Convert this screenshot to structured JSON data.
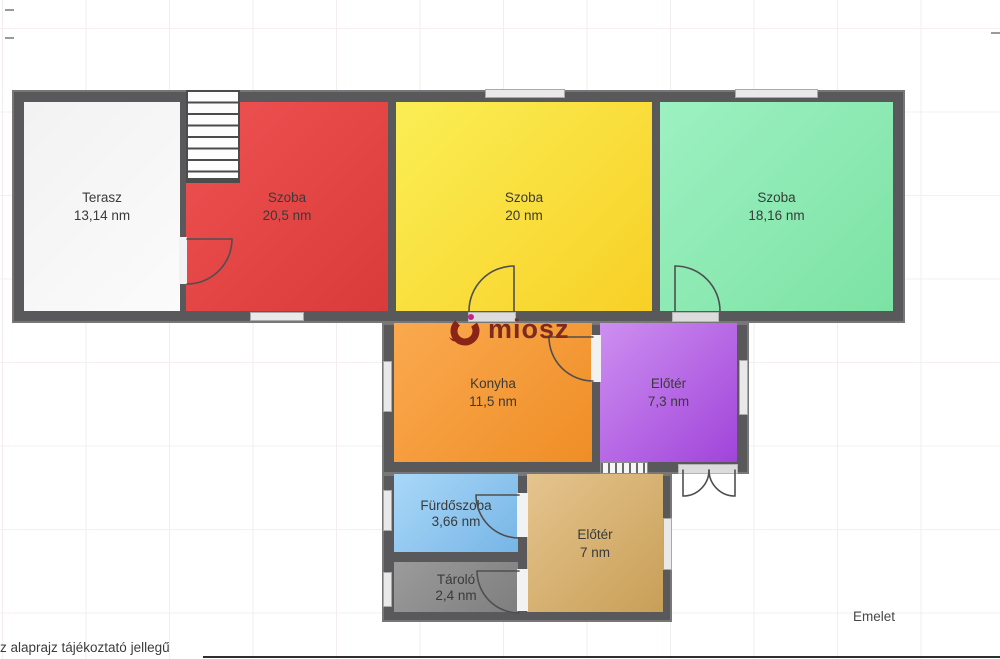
{
  "meta": {
    "floor_label": "Emelet",
    "disclaimer": "z alaprajz tájékoztató jellegű",
    "plan_type": "floor-plan"
  },
  "logo": {
    "text": "miosz",
    "text_color": "#7d2b1f",
    "swirl_color": "#8a2416",
    "dot_color": "#c2258a"
  },
  "palette": {
    "wall": "#59595b",
    "background": "#ffffff",
    "grid_line": "#f3eded",
    "window_fill": "#e9e9e9"
  },
  "rooms": [
    {
      "id": "terasz",
      "name": "Terasz",
      "area": "13,14 nm",
      "color": "#f2f2f2",
      "color2": "#fbfbfb"
    },
    {
      "id": "szoba-1",
      "name": "Szoba",
      "area": "20,5 nm",
      "color": "#ef5252",
      "color2": "#d93a3a"
    },
    {
      "id": "szoba-2",
      "name": "Szoba",
      "area": "20 nm",
      "color": "#faee55",
      "color2": "#f8d026"
    },
    {
      "id": "szoba-3",
      "name": "Szoba",
      "area": "18,16 nm",
      "color": "#9df1c1",
      "color2": "#7ce2a4"
    },
    {
      "id": "konyha",
      "name": "Konyha",
      "area": "11,5 nm",
      "color": "#faa94f",
      "color2": "#ef8e26"
    },
    {
      "id": "eloter-felso",
      "name": "Előtér",
      "area": "7,3 nm",
      "color": "#cd8ff0",
      "color2": "#a144da"
    },
    {
      "id": "furdoszoba",
      "name": "Fürdőszoba",
      "area": "3,66 nm",
      "color": "#a9d8f8",
      "color2": "#77b5e6"
    },
    {
      "id": "eloter-also",
      "name": "Előtér",
      "area": "7 nm",
      "color": "#e5c48e",
      "color2": "#c89f57"
    },
    {
      "id": "tarolo",
      "name": "Tároló",
      "area": "2,4 nm",
      "color": "#9b9b9b",
      "color2": "#7e7e7e"
    }
  ]
}
